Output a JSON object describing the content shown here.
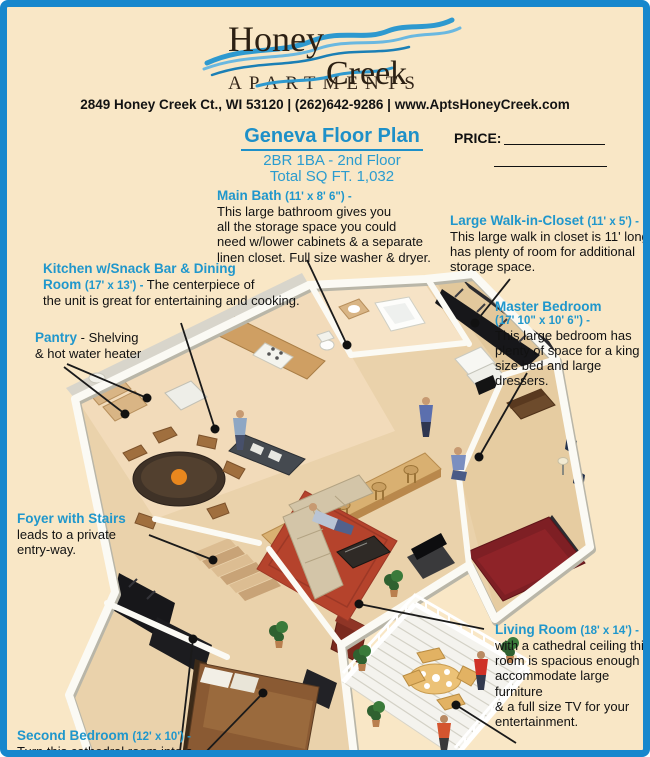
{
  "page": {
    "background": "#f9e7c6",
    "border_color": "#1787cd",
    "accent_blue": "#2097cc"
  },
  "header": {
    "brand_line1": "Honey",
    "brand_line2": "Creek",
    "brand_sub": "APARTMENTS",
    "address": "2849 Honey Creek Ct., WI 53120 | (262)642-9286 | www.AptsHoneyCreek.com"
  },
  "title_block": {
    "plan_title": "Geneva Floor Plan",
    "subtitle1": "2BR 1BA - 2nd Floor",
    "subtitle2": "Total SQ FT. 1,032",
    "price_label": "PRICE:"
  },
  "annotations": {
    "main_bath": {
      "title": "Main Bath",
      "dims": "(11' x 8' 6\") -",
      "body": "This large bathroom gives you\nall the storage space you could\nneed w/lower cabinets & a separate\nlinen closet. Full size washer & dryer."
    },
    "walk_in_closet": {
      "title": "Large Walk-in-Closet",
      "dims": "(11' x 5') -",
      "body": "This large walk in closet is 11' long\nhas plenty of room for additional\nstorage space."
    },
    "kitchen": {
      "title_line1": "Kitchen w/Snack Bar & Dining",
      "title_line2": "Room",
      "dims": "(17' x 13') -",
      "body": "The centerpiece of\nthe unit is great for entertaining and cooking."
    },
    "pantry": {
      "title": "Pantry",
      "body": "- Shelving\n& hot water heater"
    },
    "master_bedroom": {
      "title": "Master Bedroom",
      "dims": "(17' 10\" x 10' 6\") -",
      "body": "This large bedroom has\nplenty of space for a king\nsize bed and large dressers."
    },
    "foyer": {
      "title": "Foyer with Stairs",
      "body": "leads to a private\nentry-way."
    },
    "living_room": {
      "title": "Living Room",
      "dims": "(18' x 14') -",
      "body": "with a cathedral ceiling this\nroom is spacious enough to\naccommodate large furniture\n& a full size TV for your\nentertainment."
    },
    "second_bedroom": {
      "title": "Second Bedroom",
      "dims": "(12' x 10') -",
      "body": "Turn this cathedral room into a"
    },
    "private_balcony": {
      "title": "Private Balcony",
      "dims": "(11' x 8') -",
      "body": "Sliding glass"
    }
  }
}
